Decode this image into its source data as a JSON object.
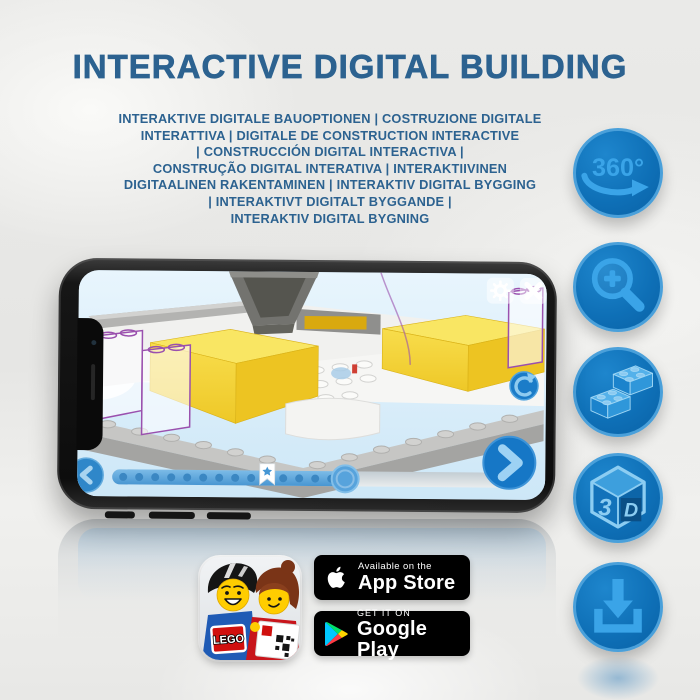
{
  "header": {
    "title": "INTERACTIVE DIGITAL BUILDING",
    "subtitle_lines": [
      "INTERAKTIVE DIGITALE BAUOPTIONEN | COSTRUZIONE DIGITALE",
      "INTERATTIVA | DIGITALE DE CONSTRUCTION INTERACTIVE",
      "| CONSTRUCCIÓN DIGITAL INTERACTIVA |",
      "CONSTRUÇÃO DIGITAL INTERATIVA | INTERAKTIIVINEN",
      "DIGITAALINEN RAKENTAMINEN | INTERAKTIV DIGITAL BYGGING",
      "| INTERAKTIVT DIGITALT BYGGANDE |",
      "INTERAKTIV DIGITAL BYGNING"
    ]
  },
  "feature_rail": {
    "rotate_label": "360°",
    "cube_left_face": "3",
    "cube_right_face": "D",
    "icon_names": [
      "360-rotation-icon",
      "zoom-in-icon",
      "lego-bricks-icon",
      "3d-cube-icon",
      "download-icon"
    ]
  },
  "phone_screen": {
    "slider": {
      "progress_percent": 57,
      "bookmark_percent": 38
    },
    "buttons": [
      "settings",
      "close",
      "refresh",
      "previous-step",
      "next-step"
    ]
  },
  "badges": {
    "app_store": {
      "top_line": "Available on the",
      "store_name": "App Store"
    },
    "google_play": {
      "top_line": "GET IT ON",
      "store_name": "Google Play"
    }
  },
  "app_icon": {
    "logo_text": "LEGO"
  },
  "colors": {
    "heading_blue": "#2c6290",
    "circle_fill": "#0e6fb6",
    "circle_ring": "#4aa0da",
    "glyph_blue": "#3aa4e8",
    "screen_button_blue": "#1677c6",
    "brick_yellow": "#f2d035",
    "ghost_outline_purple": "#9a50ae",
    "badge_background": "#000000"
  }
}
